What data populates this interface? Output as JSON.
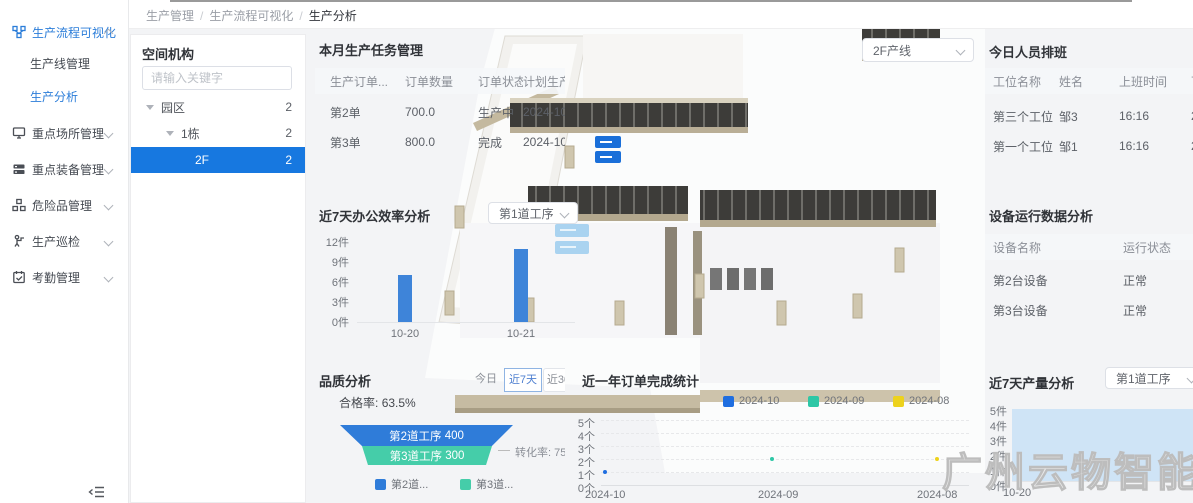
{
  "breadcrumb": {
    "items": [
      "生产管理",
      "生产流程可视化",
      "生产分析"
    ]
  },
  "sidebar": {
    "group": {
      "label": "生产流程可视化",
      "children": [
        {
          "label": "生产线管理"
        },
        {
          "label": "生产分析"
        }
      ]
    },
    "items": [
      {
        "label": "重点场所管理",
        "icon": "monitor-icon"
      },
      {
        "label": "重点装备管理",
        "icon": "equipment-icon"
      },
      {
        "label": "危险品管理",
        "icon": "hazard-icon"
      },
      {
        "label": "生产巡检",
        "icon": "patrol-icon"
      },
      {
        "label": "考勤管理",
        "icon": "attendance-icon"
      }
    ]
  },
  "space_panel": {
    "title": "空间机构",
    "search_placeholder": "请输入关键字",
    "tree": [
      {
        "label": "园区",
        "count": "2"
      },
      {
        "label": "1栋",
        "count": "2"
      },
      {
        "label": "2F",
        "count": "2",
        "selected": true
      }
    ]
  },
  "map": {
    "line_select_value": "2F产线"
  },
  "task_panel": {
    "title": "本月生产任务管理",
    "columns": [
      "生产订单...",
      "订单数量",
      "订单状态",
      "计划生产..."
    ],
    "rows": [
      [
        "第2单",
        "700.0",
        "生产中",
        "2024-10-22..."
      ],
      [
        "第3单",
        "800.0",
        "完成",
        "2024-10-22..."
      ]
    ]
  },
  "efficiency_panel": {
    "title": "近7天办公效率分析",
    "process_select_value": "第1道工序",
    "chart_data": {
      "type": "bar",
      "categories": [
        "10-20",
        "10-21"
      ],
      "values": [
        7,
        11
      ],
      "yticks": [
        "12件",
        "9件",
        "6件",
        "3件",
        "0件"
      ],
      "ylim": [
        0,
        12
      ],
      "bar_color": "#3e84d9"
    }
  },
  "quality_panel": {
    "title": "品质分析",
    "range_buttons": [
      "今日",
      "近7天",
      "近30天"
    ],
    "active_range": "近7天",
    "pass_rate_label": "合格率:",
    "pass_rate_value": "63.5%",
    "conversion_label": "转化率:",
    "conversion_value": "75.00",
    "legend": [
      "第2道...",
      "第3道..."
    ],
    "chart_data": {
      "type": "funnel",
      "stages": [
        {
          "label": "第2道工序",
          "value": "400",
          "color": "#2f7cd9"
        },
        {
          "label": "第3道工序",
          "value": "300",
          "color": "#45cda9"
        }
      ],
      "conversion_rate": 75.0
    }
  },
  "orders_panel": {
    "title": "近一年订单完成统计",
    "chart_data": {
      "type": "line",
      "legend": [
        {
          "label": "2024-10",
          "color": "#1f6ee0"
        },
        {
          "label": "2024-09",
          "color": "#2ec7a6"
        },
        {
          "label": "2024-08",
          "color": "#edd21c"
        }
      ],
      "yticks": [
        "5个",
        "4个",
        "3个",
        "2个",
        "1个",
        "0个"
      ],
      "ylim": [
        0,
        5
      ],
      "x_categories": [
        "2024-10",
        "2024-09",
        "2024-08"
      ],
      "points": [
        {
          "series": "2024-10",
          "x": "2024-10",
          "y": 1
        },
        {
          "series": "2024-09",
          "x": "2024-09",
          "y": 2
        },
        {
          "series": "2024-08",
          "x": "2024-08",
          "y": 2
        }
      ]
    }
  },
  "schedule_panel": {
    "title": "今日人员排班",
    "columns": [
      "工位名称",
      "姓名",
      "上班时间",
      "下班时间"
    ],
    "rows": [
      [
        "第三个工位",
        "邹3",
        "16:16",
        "2024-10-22"
      ],
      [
        "第一个工位",
        "邹1",
        "16:16",
        "2024-10-22"
      ]
    ]
  },
  "equipment_panel": {
    "title": "设备运行数据分析",
    "columns": [
      "设备名称",
      "运行状态"
    ],
    "rows": [
      [
        "第2台设备",
        "正常"
      ],
      [
        "第3台设备",
        "正常"
      ]
    ]
  },
  "production_panel": {
    "title": "近7天产量分析",
    "process_select_value": "第1道工序",
    "chart_data": {
      "type": "area",
      "x": [
        "10-20"
      ],
      "values": [
        5
      ],
      "yticks": [
        "5件",
        "4件",
        "3件",
        "2件",
        "1件",
        "0件"
      ],
      "ylim": [
        0,
        5
      ],
      "fill_color": "#cfe4f6"
    }
  },
  "watermark": {
    "text": "广州云物智能"
  }
}
